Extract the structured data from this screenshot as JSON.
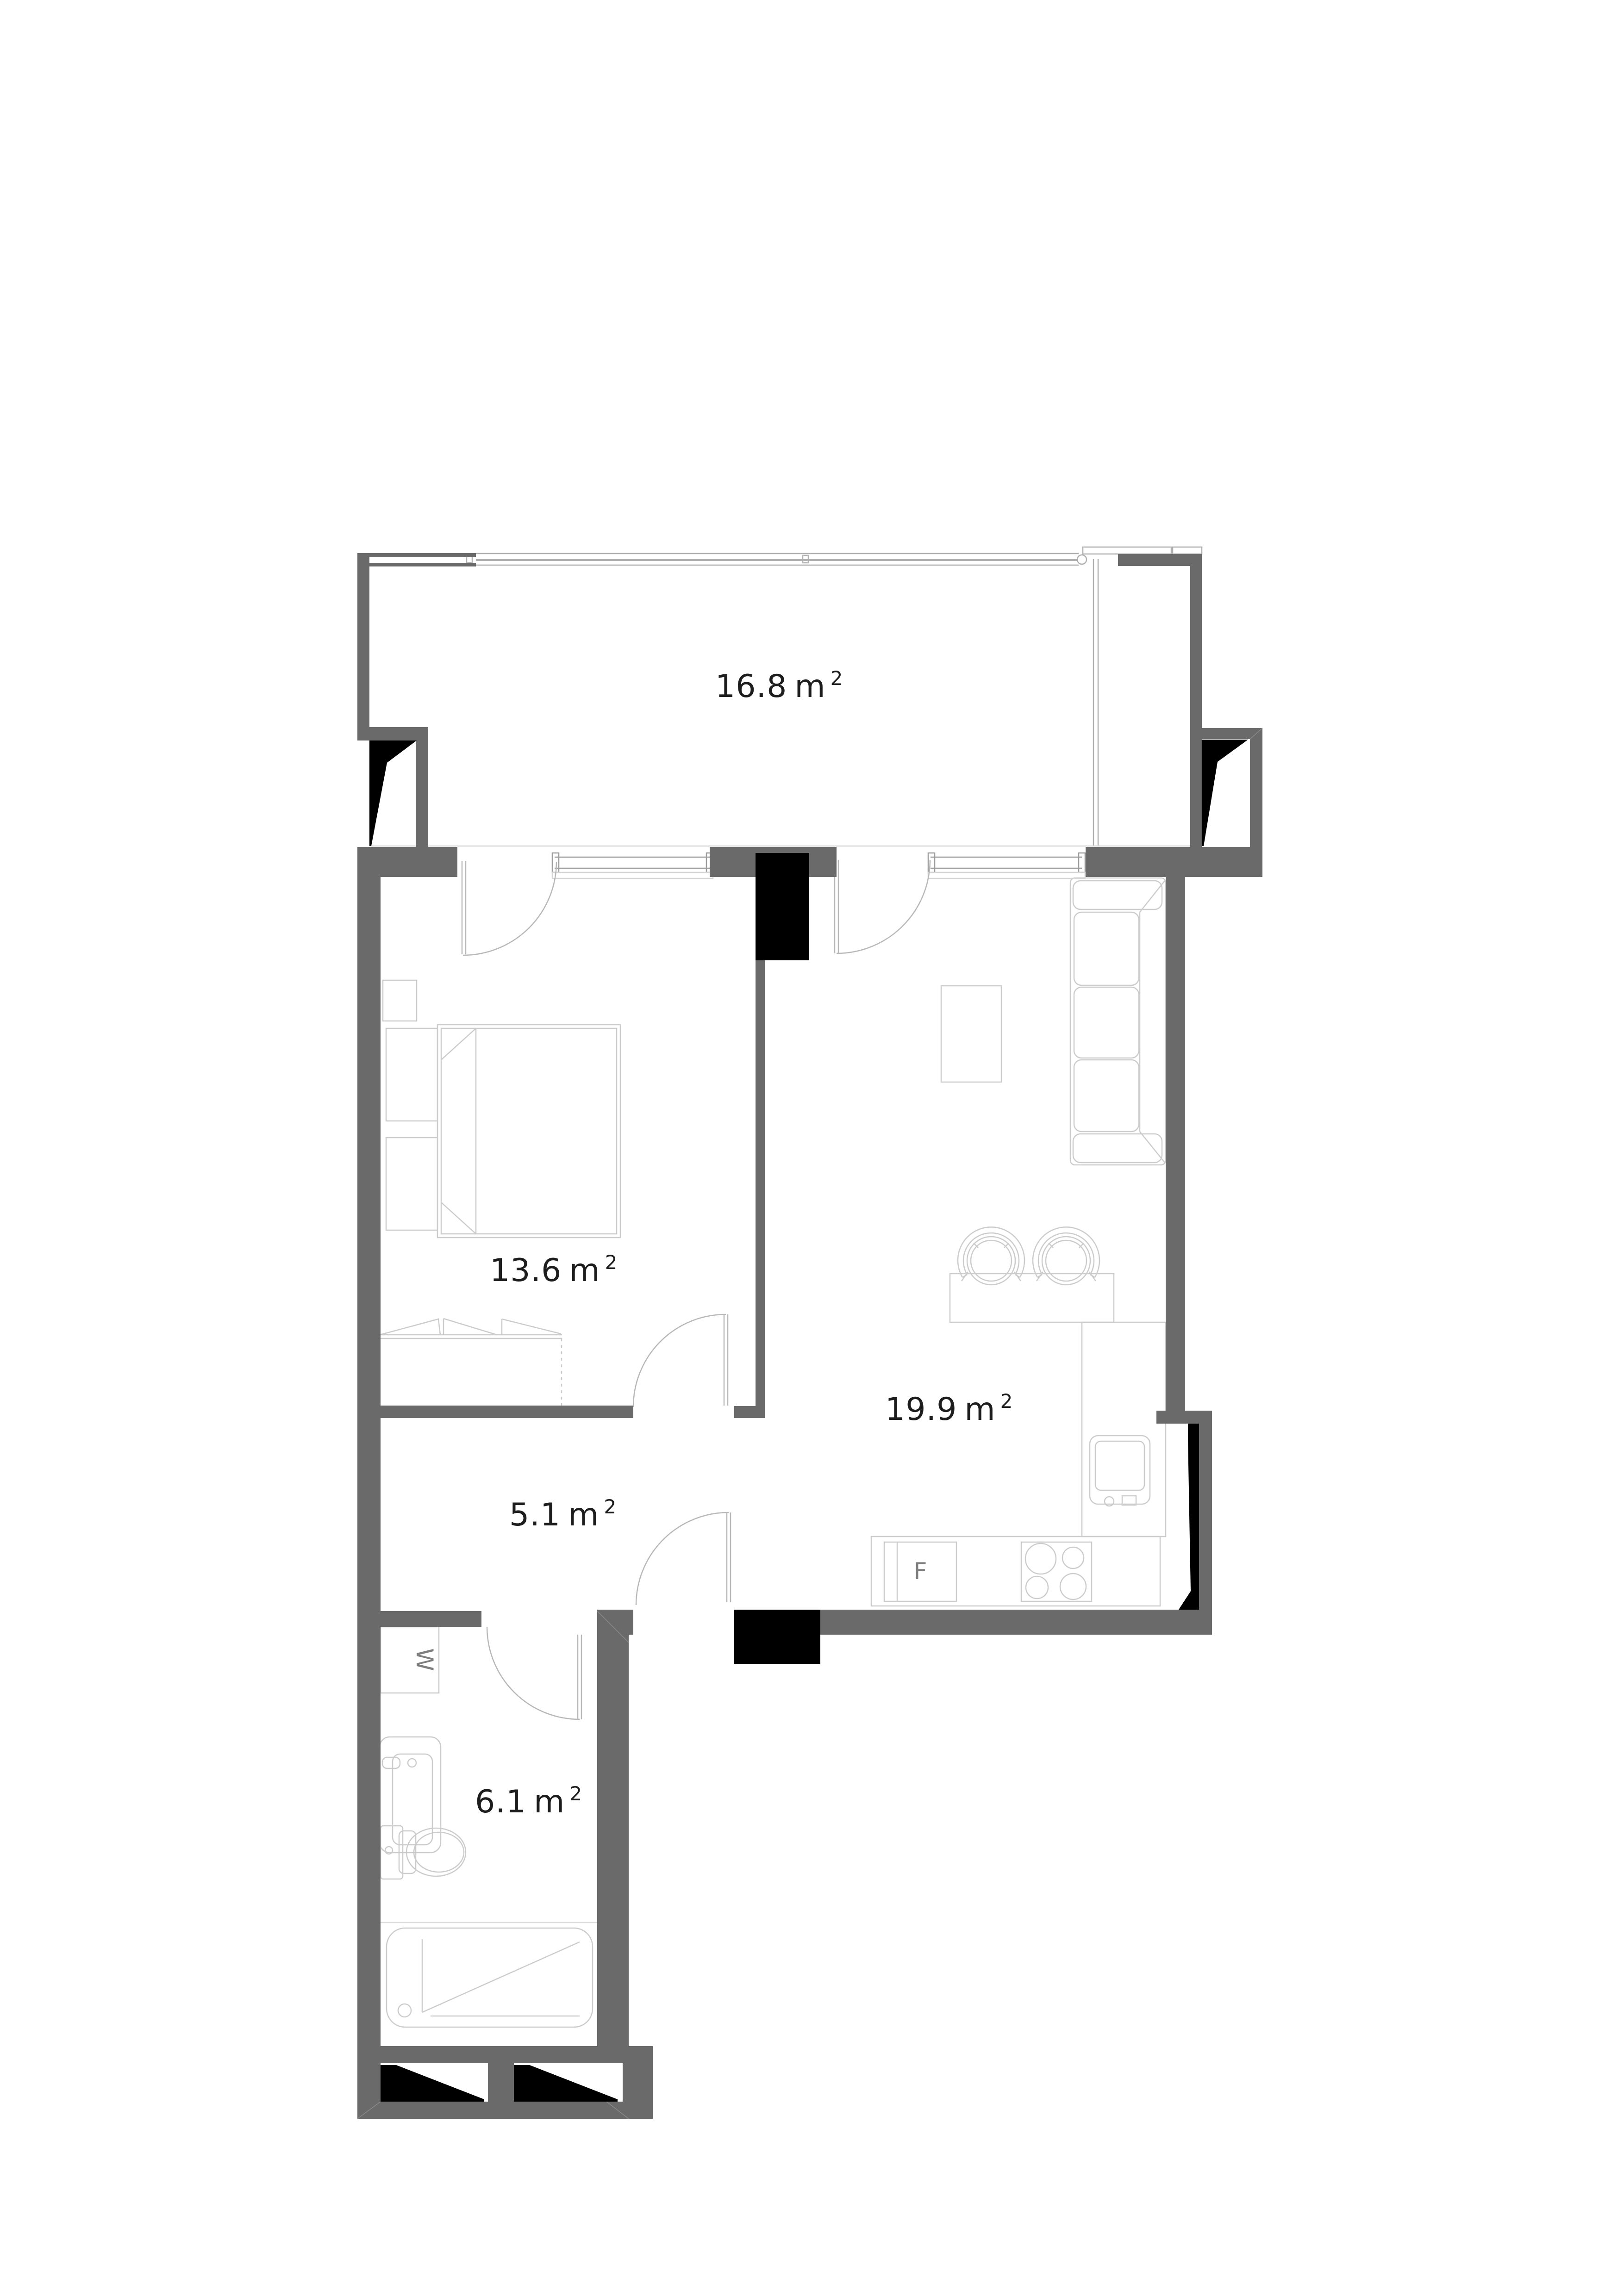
{
  "page": {
    "background": "#ffffff"
  },
  "floorplan": {
    "colors": {
      "wall": "#6a6a6a",
      "shaft": "#000000",
      "furniture_line": "#cccccc",
      "door_line": "#b8b8b8",
      "glazing_line": "#b0b0b0",
      "window_line": "#9d9d9d",
      "floor_edge_line": "#d5d5d5",
      "label_text": "#1d1d1d",
      "appliance_text": "#7e7e7e"
    },
    "rooms": [
      {
        "id": "terrace",
        "area": "16.8",
        "unit": "m",
        "sup": "2"
      },
      {
        "id": "bedroom",
        "area": "13.6",
        "unit": "m",
        "sup": "2"
      },
      {
        "id": "living-kitchen",
        "area": "19.9",
        "unit": "m",
        "sup": "2"
      },
      {
        "id": "hallway",
        "area": "5.1",
        "unit": "m",
        "sup": "2"
      },
      {
        "id": "bathroom",
        "area": "6.1",
        "unit": "m",
        "sup": "2"
      }
    ],
    "appliances": {
      "fridge_label": "F",
      "washer_label": "W"
    }
  }
}
